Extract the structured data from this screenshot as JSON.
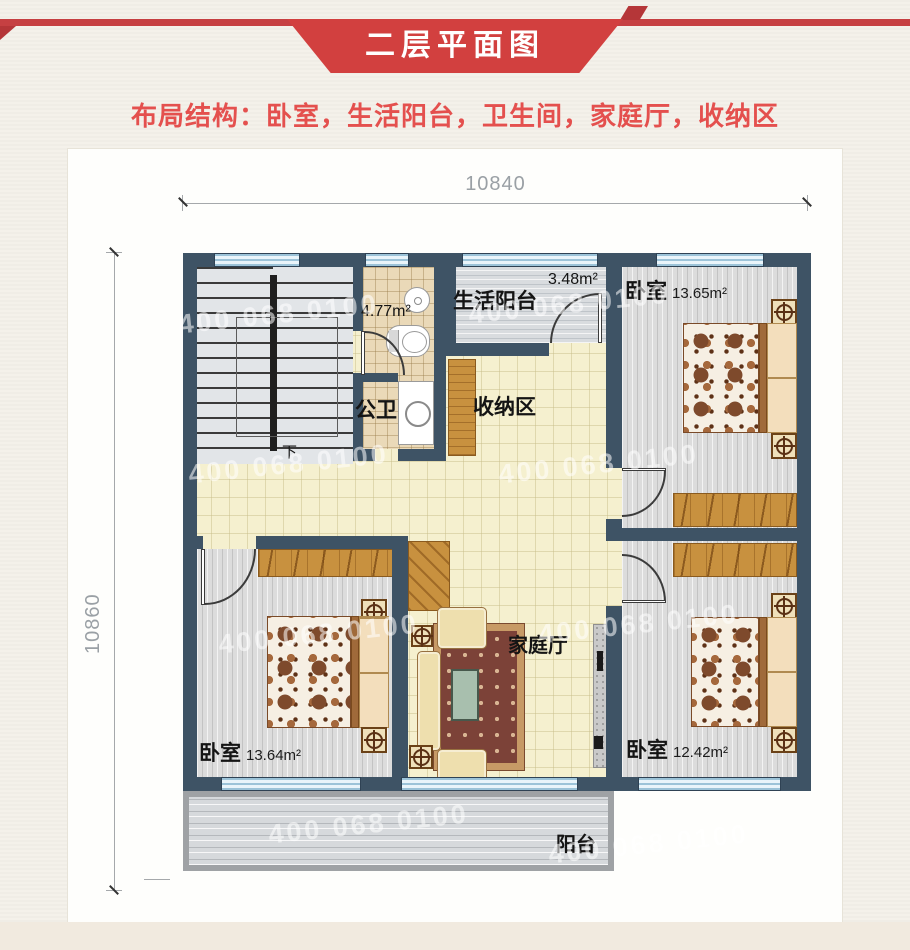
{
  "header": {
    "banner_title": "二层平面图",
    "subtitle": "布局结构：卧室，生活阳台，卫生间，家庭厅，收纳区"
  },
  "dims": {
    "top": "10840",
    "left": "10860"
  },
  "rooms": {
    "bath_upper": {
      "area": "4.77m²"
    },
    "bath": {
      "name": "公卫"
    },
    "living_balcony": {
      "name": "生活阳台",
      "area": "3.48m²"
    },
    "bedroom_tr": {
      "name": "卧室",
      "area": "13.65m²"
    },
    "storage": {
      "name": "收纳区"
    },
    "family_hall": {
      "name": "家庭厅"
    },
    "bedroom_bl": {
      "name": "卧室",
      "area": "13.64m²"
    },
    "bedroom_br": {
      "name": "卧室",
      "area": "12.42m²"
    },
    "balcony": {
      "name": "阳台"
    },
    "stairs": {
      "direction": "下"
    }
  },
  "watermark": {
    "text": "400 068 0100"
  },
  "colors": {
    "banner_red": "#d2403f",
    "accent_text": "#e4504e",
    "wall": "#3e5365",
    "window": "#cde4f0",
    "floor_cream": "#f5f0cf",
    "wood": "#c8913f"
  }
}
